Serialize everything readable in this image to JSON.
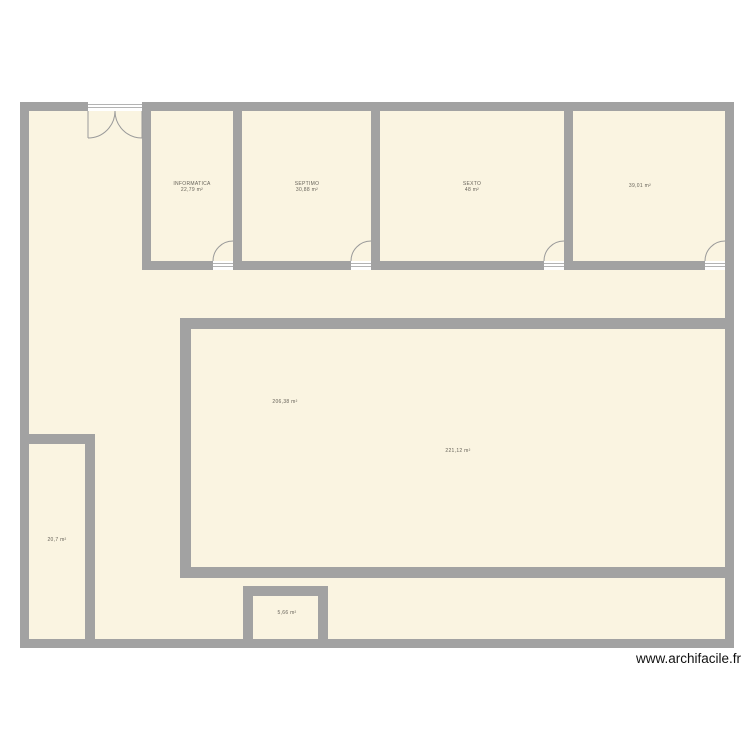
{
  "plan": {
    "watermark": "www.archifacile.fr",
    "rooms": {
      "informatica": {
        "name": "INFORMATICA",
        "area": "22,79 m²"
      },
      "septimo": {
        "name": "SEPTIMO",
        "area": "30,88 m²"
      },
      "sexto": {
        "name": "SEXTO",
        "area": "48 m²"
      },
      "aula_derecha": {
        "area": "39,01 m²"
      },
      "hall": {
        "area": "206,38 m²"
      },
      "sala_grande": {
        "area": "221,12 m²"
      },
      "cuarto_izquierdo": {
        "area": "20,7 m²"
      },
      "cuarto_pequeno": {
        "area": "5,66 m²"
      }
    },
    "colors": {
      "wall": "#a2a2a2",
      "floor": "#faf4e1",
      "door_arc": "#9a9a9a",
      "label_text": "#67635a",
      "watermark_text": "#111111",
      "background": "#ffffff"
    }
  }
}
